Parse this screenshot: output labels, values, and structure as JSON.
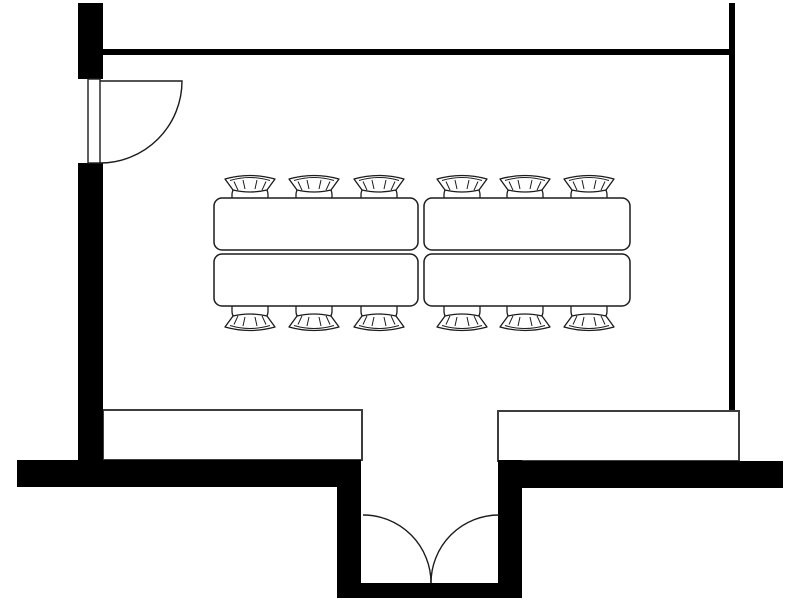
{
  "diagram": {
    "type": "floor-plan",
    "name": "meeting-room-floor-plan",
    "canvas": {
      "width": 800,
      "height": 600,
      "background": "#ffffff"
    },
    "colors": {
      "wall": "#000000",
      "furniture_outline": "#1c1c1c",
      "counter_outline": "#3d3d3d",
      "fill": "#ffffff"
    },
    "counts": {
      "tables": 4,
      "chairs": 12,
      "single_doors": 1,
      "double_doors": 1,
      "counters": 2
    },
    "walls": [
      {
        "name": "left-wall-upper",
        "x": 78,
        "y": 3,
        "w": 25,
        "h": 76
      },
      {
        "name": "left-wall-lower",
        "x": 78,
        "y": 163,
        "w": 25,
        "h": 297
      },
      {
        "name": "top-wall",
        "x": 103,
        "y": 49,
        "w": 631,
        "h": 6
      },
      {
        "name": "right-wall",
        "x": 729,
        "y": 3,
        "w": 6,
        "h": 407
      },
      {
        "name": "bottom-wall-left",
        "x": 17,
        "y": 460,
        "w": 344,
        "h": 27
      },
      {
        "name": "bottom-wall-right",
        "x": 498,
        "y": 461,
        "w": 285,
        "h": 27
      },
      {
        "name": "entry-recess-left-wall",
        "x": 337,
        "y": 460,
        "w": 24,
        "h": 138
      },
      {
        "name": "entry-recess-right-wall",
        "x": 498,
        "y": 460,
        "w": 24,
        "h": 138
      },
      {
        "name": "entry-recess-bottom-wall",
        "x": 337,
        "y": 583,
        "w": 185,
        "h": 15
      }
    ],
    "single_door": {
      "leaf": {
        "x": 88,
        "y": 79,
        "w": 12,
        "h": 84
      },
      "swing_path": "M 100 81 L 182 81 A 82 82 0 0 1 100 163"
    },
    "double_door": {
      "left_swing_path": "M 363 515 A 68 68 0 0 1 431 583",
      "right_swing_path": "M 499 515 A 68 68 0 0 0 431 583"
    },
    "counters": [
      {
        "name": "counter-left",
        "x": 103,
        "y": 410,
        "w": 259,
        "h": 50
      },
      {
        "name": "counter-right",
        "x": 498,
        "y": 411,
        "w": 241,
        "h": 50
      }
    ],
    "tables": [
      {
        "name": "table-1",
        "x": 214,
        "y": 198,
        "w": 204,
        "h": 52,
        "r": 8
      },
      {
        "name": "table-2",
        "x": 214,
        "y": 254,
        "w": 204,
        "h": 52,
        "r": 8
      },
      {
        "name": "table-3",
        "x": 424,
        "y": 198,
        "w": 206,
        "h": 52,
        "r": 8
      },
      {
        "name": "table-4",
        "x": 424,
        "y": 254,
        "w": 206,
        "h": 52,
        "r": 8
      }
    ],
    "chairs": {
      "glyph": {
        "w": 52,
        "h": 38
      },
      "top_row": {
        "glyph_top_y": 171,
        "centers_x": [
          250,
          314,
          379,
          462,
          525,
          589
        ]
      },
      "bottom_row": {
        "glyph_bottom_y": 335,
        "centers_x": [
          250,
          314,
          379,
          462,
          525,
          589
        ]
      }
    }
  }
}
